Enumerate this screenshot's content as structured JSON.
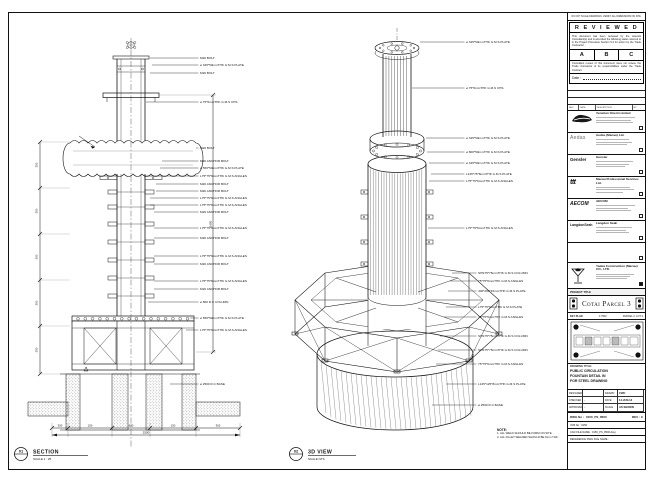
{
  "sheet": {
    "border_note": "DO NOT SCALE DRAWINGS. VERIFY ALL DIMENSIONS ON SITE.",
    "reviewed": {
      "title": "R E V I E W E D",
      "para1": "This document has been reviewed by the relevant Consultant(s) and is accorded the following status referred to in the Project Procedure Section 5.4 for action by the Trade Contractor.",
      "options": [
        "A",
        "B",
        "C"
      ],
      "para2": "Consultant review of this document does not relieve the Trade Contractor of its responsibilities under the Trade Contract.",
      "date_label": "Date :"
    },
    "revision_header": [
      "REV",
      "DATE",
      "DESCRIPTION",
      "BY"
    ],
    "consultants": [
      {
        "id": "venetian",
        "logo_text": "",
        "name": "Venetian Orient Limited"
      },
      {
        "id": "aedas",
        "logo_text": "Aedas",
        "name": "Aedas (Macau) Ltd."
      },
      {
        "id": "gensler",
        "logo_text": "Gensler",
        "name": "Gensler"
      },
      {
        "id": "ttt",
        "logo_text": "ttt",
        "name": "Macau Professional Services Ltd."
      },
      {
        "id": "aecom",
        "logo_text": "AECOM",
        "name": "AECOM"
      },
      {
        "id": "langdon",
        "logo_text": "LangdonSeah",
        "name": "Langdon Seah"
      }
    ],
    "contractor": {
      "name": "Yadea Construction (Macau) CO., LTD."
    },
    "project_title_label": "PROJECT TITLE",
    "project_title": "Cotai Parcel 3",
    "key_plan": {
      "label": "KEY PLAN",
      "scale": "1:7500",
      "sub": "PARCEL 3, LOT 2"
    },
    "title_block": {
      "drawing_title_label": "DRAWING TITLE:",
      "drawing_title_lines": [
        "PUBLIC CIRCULATION",
        "FOUNTAIN DETAIL IN",
        "FOR STEEL DRAWING"
      ],
      "fields": [
        {
          "label": "DESIGNED",
          "value": ""
        },
        {
          "label": "DRAWN",
          "value": "CWC"
        },
        {
          "label": "CHECKED",
          "value": "-"
        },
        {
          "label": "DATE",
          "value": "14-JUN-13"
        },
        {
          "label": "APPROVED",
          "value": "-"
        },
        {
          "label": "SCALE",
          "value": "AS SHOWN"
        }
      ],
      "dwg_no_label": "DWG No :",
      "dwg_no": "0150_PS_8500",
      "rev_label": "REV : C",
      "job_label": "JOB No : 0150",
      "cad_label": "CAD FILE NAME : 0150_PS_8500.dwg",
      "ref_label": "REFERENCE DWG FILE NAME :"
    }
  },
  "drawing": {
    "section": {
      "bubble": "01",
      "title": "SECTION",
      "scale": "SCALE 1 : 25",
      "callouts": [
        "M20 BOLT",
        "ø 345*50mmTHK G.M.S PLATE",
        "M20 BOLT",
        "ø 75*6mmTHK G.M.S CHS",
        "M20 BOLT",
        "M20 ANCHOR BOLT",
        "ø 550*50mmTHK G.M.S PLATE",
        "L75*75*6mmTHK G.M.S ANGLES",
        "M20 ANCHOR BOLT",
        "M20 ANCHOR BOLT",
        "L75*75*6mmTHK G.M.S ANGLES",
        "L75*75*6mmTHK G.M.S ANGLES",
        "M20 ANCHOR BOLT",
        "L75*75*6mmTHK G.M.S ANGLES",
        "M20 ANCHOR BOLT",
        "L75*75*6mmTHK G.M.S ANGLES",
        "M20 ANCHOR BOLT",
        "L75*75*6mmTHK G.M.S ANGLES",
        "M20 ANCHOR BOLT",
        "ø 800 R.C COLUMN",
        "ø 550*50mmTHK G.M.S PLATE",
        "L75*75*6mmTHK G.M.S ANGLES",
        "ø 2500 R.C BASE"
      ],
      "dim_right": "2650",
      "dims_left": [
        "350",
        "300",
        "300",
        "300",
        "350"
      ],
      "dims_bottom": [
        "300",
        "150",
        "600",
        "150",
        "300"
      ],
      "dim_total": "2500"
    },
    "iso": {
      "bubble": "02",
      "title": "3D VIEW",
      "scale": "SCALE NTS",
      "callouts": [
        "ø 345*50mmTHK G.M.S PLATE",
        "ø 75*6mmTHK G.M.S CHS",
        "ø 345*50mmTHK G.M.S PLATE",
        "ø 800*50mmTHK G.M.S PLATE",
        "ø 345*50mmTHK G.M.S PLATE",
        "L125*75*8mmTHK G.M.S PLATE",
        "L75*75*6mmTHK G.M.S ANGLES",
        "L75*75*6mmTHK G.M.S ANGLES",
        "SHS75*75mmTHK G.M.S COLUMN",
        "75*75*6mmTHK G.M.S ANGLES",
        "400*200*16mmTHK G.M.S PLATE",
        "L75*75*6mmTHK G.M.S PLATE",
        "75*75*6mmTHK G.M.S ANGLES",
        "SHS75*75mmTHK G.M.S COLUMN",
        "SHS75*75mmTHK G.M.S COLUMN",
        "75*75*6mmTHK G.M.S ANGLES",
        "L125*125*8mmTHK G.M.S PLATE",
        "ø 2500 R.C BASE"
      ]
    },
    "note": {
      "title": "NOTE:",
      "lines": [
        "1. ALL WELD SHOULD BE FORM ON SITE.",
        "2. ALL FILLET WELDED SHOULD BE 6mm THK."
      ]
    }
  }
}
